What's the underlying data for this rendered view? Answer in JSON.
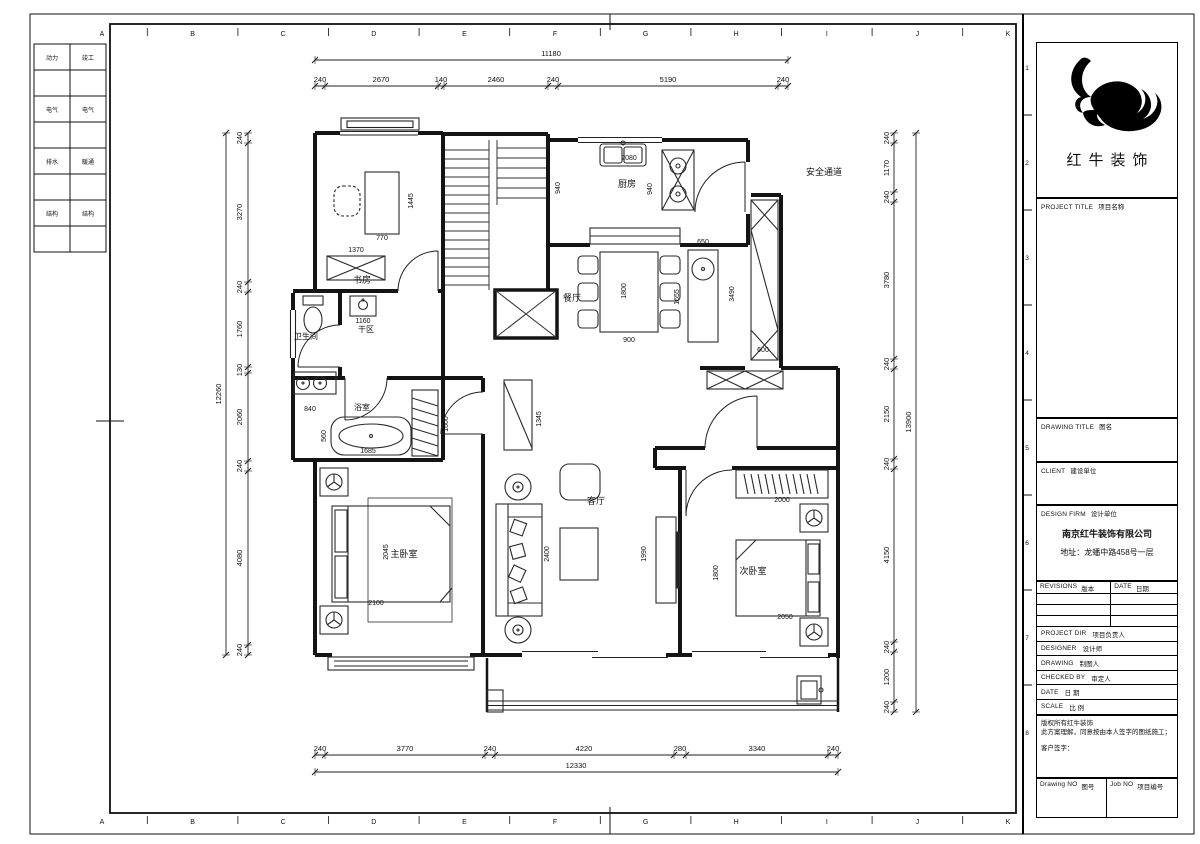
{
  "title_block": {
    "brand": "红牛装饰",
    "project_title_en": "PROJECT TITLE",
    "project_title_cn": "项目名称",
    "drawing_title_en": "DRAWING TITLE",
    "drawing_title_cn": "图名",
    "client_en": "CLIENT",
    "client_cn": "建设单位",
    "design_firm_en": "DESIGN FIRM",
    "design_firm_cn": "设计单位",
    "firm_name": "南京红牛装饰有限公司",
    "firm_address": "地址：龙蟠中路458号一层",
    "revisions_en": "REVISIONS",
    "revisions_cn": "版本",
    "date_col_en": "DATE",
    "date_col_cn": "日期",
    "rows": [
      {
        "en": "PROJECT DIR",
        "cn": "项目负责人"
      },
      {
        "en": "DESIGNER",
        "cn": "设计师"
      },
      {
        "en": "DRAWING",
        "cn": "制图人"
      },
      {
        "en": "CHECKED BY",
        "cn": "审定人"
      },
      {
        "en": "DATE",
        "cn": "日  期"
      },
      {
        "en": "SCALE",
        "cn": "比  例"
      }
    ],
    "copyright_line1": "版权所有红牛装饰",
    "copyright_line2": "此方案理解，同意按由本人签字的图纸施工；",
    "signature_label": "客户签字：",
    "drawing_no_en": "Drawing NO",
    "drawing_no_cn": "图号",
    "job_no_en": "Job NO",
    "job_no_cn": "项目编号"
  },
  "grid": {
    "letters": [
      "A",
      "B",
      "C",
      "D",
      "E",
      "F",
      "G",
      "H",
      "I",
      "J",
      "K"
    ],
    "numbers": [
      "1",
      "2",
      "3",
      "4",
      "5",
      "6",
      "7",
      "8"
    ]
  },
  "plan": {
    "labels": [
      {
        "t": "动力",
        "x": 52,
        "y": 60,
        "s": 6
      },
      {
        "t": "竣工",
        "x": 88,
        "y": 60,
        "s": 6
      },
      {
        "t": "电气",
        "x": 52,
        "y": 112,
        "s": 6
      },
      {
        "t": "电气",
        "x": 88,
        "y": 112,
        "s": 6
      },
      {
        "t": "排水",
        "x": 52,
        "y": 164,
        "s": 6
      },
      {
        "t": "暖通",
        "x": 88,
        "y": 164,
        "s": 6
      },
      {
        "t": "结构",
        "x": 52,
        "y": 216,
        "s": 6
      },
      {
        "t": "结构",
        "x": 88,
        "y": 216,
        "s": 6
      },
      {
        "t": "11180",
        "x": 551,
        "y": 56
      },
      {
        "t": "240",
        "x": 320,
        "y": 82
      },
      {
        "t": "2670",
        "x": 381,
        "y": 82
      },
      {
        "t": "140",
        "x": 441,
        "y": 82
      },
      {
        "t": "2460",
        "x": 496,
        "y": 82
      },
      {
        "t": "240",
        "x": 553,
        "y": 82
      },
      {
        "t": "5190",
        "x": 668,
        "y": 82
      },
      {
        "t": "240",
        "x": 783,
        "y": 82
      },
      {
        "t": "240",
        "x": 320,
        "y": 751
      },
      {
        "t": "3770",
        "x": 405,
        "y": 751
      },
      {
        "t": "240",
        "x": 490,
        "y": 751
      },
      {
        "t": "4220",
        "x": 584,
        "y": 751
      },
      {
        "t": "280",
        "x": 680,
        "y": 751
      },
      {
        "t": "3340",
        "x": 757,
        "y": 751
      },
      {
        "t": "240",
        "x": 833,
        "y": 751
      },
      {
        "t": "12330",
        "x": 576,
        "y": 768
      },
      {
        "t": "240",
        "x": 242,
        "y": 138,
        "r": -90
      },
      {
        "t": "3270",
        "x": 242,
        "y": 212,
        "r": -90
      },
      {
        "t": "240",
        "x": 242,
        "y": 287,
        "r": -90
      },
      {
        "t": "1760",
        "x": 242,
        "y": 329,
        "r": -90
      },
      {
        "t": "130",
        "x": 242,
        "y": 370,
        "r": -90
      },
      {
        "t": "2060",
        "x": 242,
        "y": 417,
        "r": -90
      },
      {
        "t": "240",
        "x": 242,
        "y": 466,
        "r": -90
      },
      {
        "t": "4080",
        "x": 242,
        "y": 558,
        "r": -90
      },
      {
        "t": "240",
        "x": 242,
        "y": 650,
        "r": -90
      },
      {
        "t": "12260",
        "x": 221,
        "y": 394,
        "r": -90
      },
      {
        "t": "240",
        "x": 889,
        "y": 138,
        "r": -90
      },
      {
        "t": "1170",
        "x": 889,
        "y": 168,
        "r": -90
      },
      {
        "t": "240",
        "x": 889,
        "y": 197,
        "r": -90
      },
      {
        "t": "3780",
        "x": 889,
        "y": 280,
        "r": -90
      },
      {
        "t": "240",
        "x": 889,
        "y": 364,
        "r": -90
      },
      {
        "t": "2150",
        "x": 889,
        "y": 414,
        "r": -90
      },
      {
        "t": "240",
        "x": 889,
        "y": 464,
        "r": -90
      },
      {
        "t": "4150",
        "x": 889,
        "y": 555,
        "r": -90
      },
      {
        "t": "240",
        "x": 889,
        "y": 647,
        "r": -90
      },
      {
        "t": "1200",
        "x": 889,
        "y": 677,
        "r": -90
      },
      {
        "t": "240",
        "x": 889,
        "y": 707,
        "r": -90
      },
      {
        "t": "13900",
        "x": 911,
        "y": 422,
        "r": -90
      },
      {
        "t": "书房",
        "x": 362,
        "y": 283,
        "s": 9
      },
      {
        "t": "厨房",
        "x": 627,
        "y": 187,
        "s": 9
      },
      {
        "t": "餐厅",
        "x": 572,
        "y": 301,
        "s": 9
      },
      {
        "t": "客厅",
        "x": 596,
        "y": 504,
        "s": 9
      },
      {
        "t": "主卧室",
        "x": 404,
        "y": 557,
        "s": 9
      },
      {
        "t": "次卧室",
        "x": 753,
        "y": 574,
        "s": 9
      },
      {
        "t": "卫生间",
        "x": 306,
        "y": 339,
        "s": 8
      },
      {
        "t": "干区",
        "x": 366,
        "y": 332,
        "s": 8
      },
      {
        "t": "浴室",
        "x": 362,
        "y": 410,
        "s": 8
      },
      {
        "t": "安全通道",
        "x": 824,
        "y": 175,
        "s": 9
      },
      {
        "t": "1445",
        "x": 413,
        "y": 201,
        "r": -90,
        "s": 7
      },
      {
        "t": "770",
        "x": 382,
        "y": 240,
        "s": 7
      },
      {
        "t": "1370",
        "x": 356,
        "y": 252,
        "s": 7
      },
      {
        "t": "1160",
        "x": 363,
        "y": 323,
        "s": 7
      },
      {
        "t": "840",
        "x": 310,
        "y": 411,
        "s": 7
      },
      {
        "t": "560",
        "x": 326,
        "y": 436,
        "r": -90,
        "s": 7
      },
      {
        "t": "1685",
        "x": 368,
        "y": 453,
        "s": 7
      },
      {
        "t": "1600",
        "x": 448,
        "y": 424,
        "r": -90,
        "s": 7
      },
      {
        "t": "1345",
        "x": 541,
        "y": 419,
        "r": -90,
        "s": 7
      },
      {
        "t": "2080",
        "x": 629,
        "y": 160,
        "s": 7
      },
      {
        "t": "940",
        "x": 560,
        "y": 188,
        "r": -90,
        "s": 7
      },
      {
        "t": "940",
        "x": 652,
        "y": 189,
        "r": -90,
        "s": 7
      },
      {
        "t": "650",
        "x": 703,
        "y": 244,
        "s": 7
      },
      {
        "t": "1655",
        "x": 679,
        "y": 297,
        "r": -90,
        "s": 7
      },
      {
        "t": "1800",
        "x": 626,
        "y": 291,
        "r": -90,
        "s": 7
      },
      {
        "t": "900",
        "x": 629,
        "y": 342,
        "s": 7
      },
      {
        "t": "3490",
        "x": 734,
        "y": 294,
        "r": -90,
        "s": 7
      },
      {
        "t": "600",
        "x": 763,
        "y": 352,
        "s": 7
      },
      {
        "t": "2045",
        "x": 388,
        "y": 552,
        "r": -90,
        "s": 7
      },
      {
        "t": "2100",
        "x": 376,
        "y": 605,
        "s": 7
      },
      {
        "t": "2400",
        "x": 549,
        "y": 554,
        "r": -90,
        "s": 7
      },
      {
        "t": "1990",
        "x": 646,
        "y": 554,
        "r": -90,
        "s": 7
      },
      {
        "t": "2000",
        "x": 782,
        "y": 502,
        "s": 7
      },
      {
        "t": "1800",
        "x": 718,
        "y": 573,
        "r": -90,
        "s": 7
      },
      {
        "t": "2050",
        "x": 785,
        "y": 619,
        "s": 7
      }
    ]
  }
}
